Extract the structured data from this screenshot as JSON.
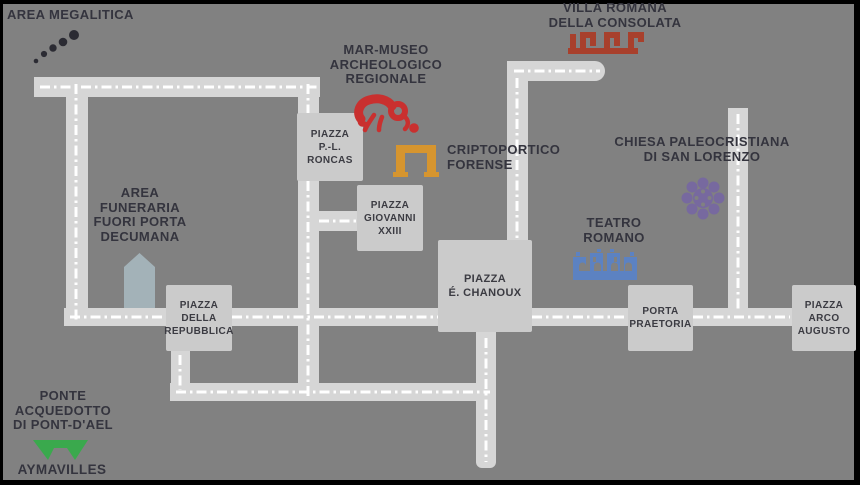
{
  "map": {
    "name": "aosta-archaeological-sites-map",
    "palette": {
      "background": "#818181",
      "road": "#d6d6d6",
      "road_centerline": "#ffffff",
      "square_block": "#cbcbcb",
      "label_text": "#34343e",
      "frame": "#000000"
    },
    "sites": [
      {
        "id": "area-megalitica",
        "icon": "megaliths-icon",
        "color": "#2b2b33",
        "lines": [
          "AREA MEGALITICA"
        ]
      },
      {
        "id": "villa-romana",
        "icon": "meander-icon",
        "color": "#a8402c",
        "lines": [
          "VILLA ROMANA",
          "DELLA CONSOLATA"
        ]
      },
      {
        "id": "mar-museo",
        "icon": "horse-icon",
        "color": "#c9302f",
        "lines": [
          "MAR-MUSEO",
          "ARCHEOLOGICO",
          "REGIONALE"
        ]
      },
      {
        "id": "criptoportico",
        "icon": "arch-icon",
        "color": "#d6952f",
        "lines": [
          "CRIPTOPORTICO",
          "FORENSE"
        ]
      },
      {
        "id": "chiesa-san-lorenzo",
        "icon": "rosette-icon",
        "color": "#77699f",
        "lines": [
          "CHIESA PALEOCRISTIANA",
          "DI SAN LORENZO"
        ]
      },
      {
        "id": "teatro-romano",
        "icon": "theatre-icon",
        "color": "#5c82c2",
        "lines": [
          "TEATRO",
          "ROMANO"
        ]
      },
      {
        "id": "area-funeraria",
        "icon": "mausoleum-icon",
        "color": "#a3b2b8",
        "lines": [
          "AREA",
          "FUNERARIA",
          "FUORI PORTA",
          "DECUMANA"
        ]
      },
      {
        "id": "ponte-acquedotto",
        "icon": "bridge-icon",
        "color": "#3aa94d",
        "lines": [
          "PONTE",
          "ACQUEDOTTO",
          "DI PONT-D'AEL"
        ]
      },
      {
        "id": "aymavilles",
        "icon": "",
        "color": "#34343e",
        "lines": [
          "AYMAVILLES"
        ]
      }
    ],
    "squares": [
      {
        "id": "piazza-roncas",
        "lines": [
          "PIAZZA",
          "P.-L. RONCAS"
        ]
      },
      {
        "id": "piazza-giovanni",
        "lines": [
          "PIAZZA",
          "GIOVANNI",
          "XXIII"
        ]
      },
      {
        "id": "piazza-chanoux",
        "lines": [
          "PIAZZA",
          "É. CHANOUX"
        ]
      },
      {
        "id": "piazza-repubblica",
        "lines": [
          "PIAZZA",
          "DELLA",
          "REPUBBLICA"
        ]
      },
      {
        "id": "porta-praetoria",
        "lines": [
          "PORTA",
          "PRAETORIA"
        ]
      },
      {
        "id": "piazza-arco-augusto",
        "lines": [
          "PIAZZA",
          "ARCO",
          "AUGUSTO"
        ]
      }
    ]
  }
}
